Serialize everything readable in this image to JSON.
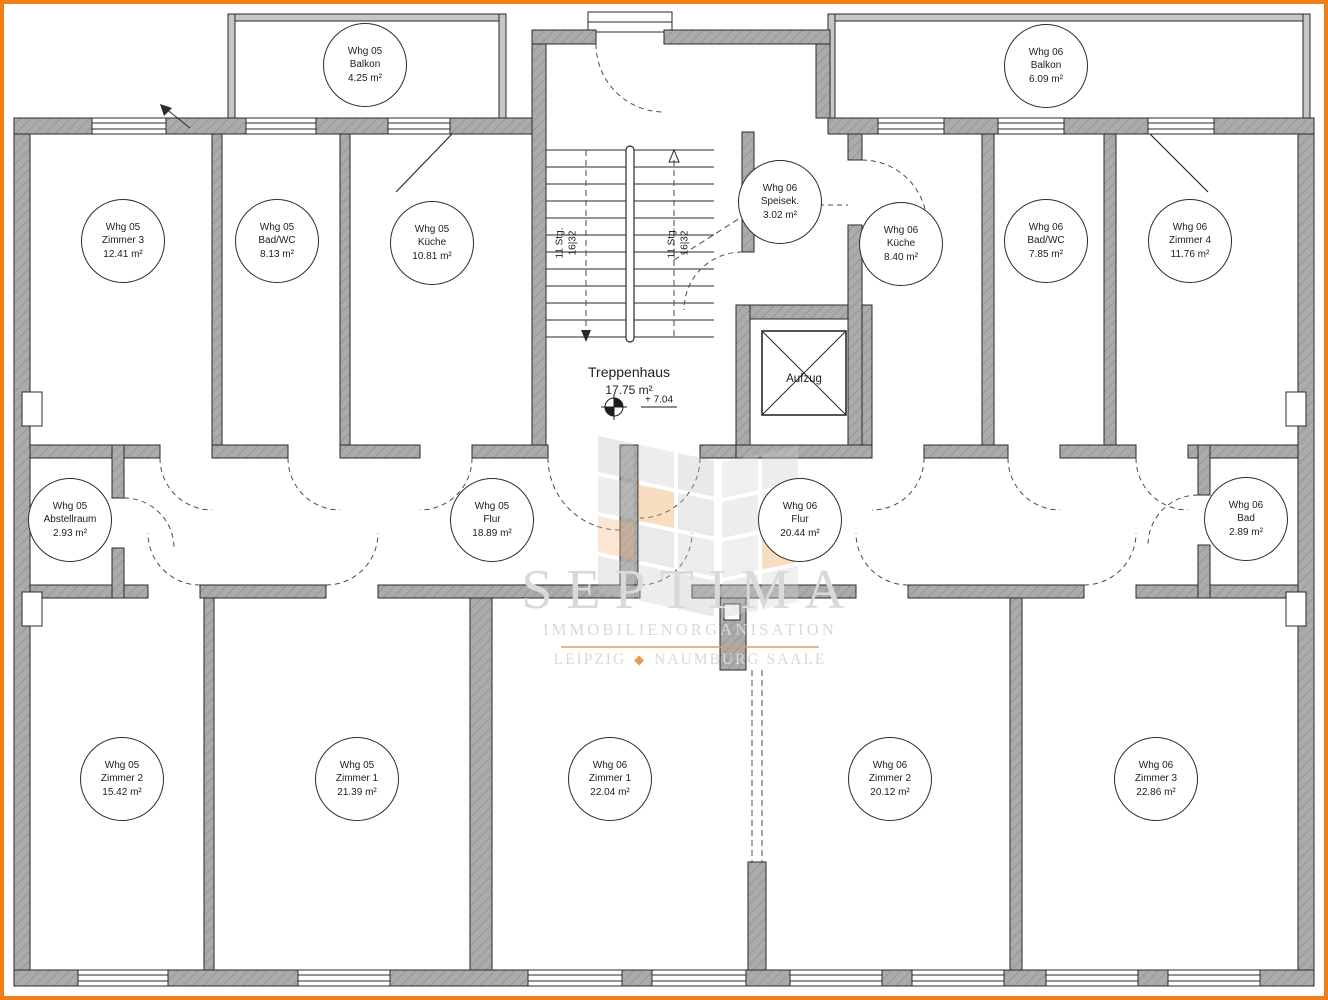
{
  "plan": {
    "border_color": "#f07f18",
    "wall_color": "#ababab",
    "line_color": "#2a2a2a"
  },
  "stairwell": {
    "name": "Treppenhaus",
    "area": "17.75 m²",
    "level": "+ 7.04",
    "flight_label": "11 Stg.",
    "flight_ratio": "16|32",
    "elevator": "Aufzug"
  },
  "watermark": {
    "brand": "SEPTIMA",
    "sub": "IMMOBILIENORGANISATION",
    "city1": "LEIPZIG",
    "sep": "◆",
    "city2": "NAUMBURG SAALE"
  },
  "rooms": [
    {
      "unit": "Whg 05",
      "name": "Balkon",
      "area": "4.25 m²",
      "cx": 365,
      "cy": 65
    },
    {
      "unit": "Whg 06",
      "name": "Balkon",
      "area": "6.09 m²",
      "cx": 1046,
      "cy": 66
    },
    {
      "unit": "Whg 05",
      "name": "Zimmer 3",
      "area": "12.41 m²",
      "cx": 123,
      "cy": 241
    },
    {
      "unit": "Whg 05",
      "name": "Bad/WC",
      "area": "8.13 m²",
      "cx": 277,
      "cy": 241
    },
    {
      "unit": "Whg 05",
      "name": "Küche",
      "area": "10.81 m²",
      "cx": 432,
      "cy": 243
    },
    {
      "unit": "Whg 06",
      "name": "Speisek.",
      "area": "3.02 m²",
      "cx": 780,
      "cy": 202
    },
    {
      "unit": "Whg 06",
      "name": "Küche",
      "area": "8.40 m²",
      "cx": 901,
      "cy": 244
    },
    {
      "unit": "Whg 06",
      "name": "Bad/WC",
      "area": "7.85 m²",
      "cx": 1046,
      "cy": 241
    },
    {
      "unit": "Whg 06",
      "name": "Zimmer 4",
      "area": "11.76 m²",
      "cx": 1190,
      "cy": 241
    },
    {
      "unit": "Whg 05",
      "name": "Abstellraum",
      "area": "2.93 m²",
      "cx": 70,
      "cy": 520
    },
    {
      "unit": "Whg 05",
      "name": "Flur",
      "area": "18.89 m²",
      "cx": 492,
      "cy": 520
    },
    {
      "unit": "Whg 06",
      "name": "Flur",
      "area": "20.44 m²",
      "cx": 800,
      "cy": 520
    },
    {
      "unit": "Whg 06",
      "name": "Bad",
      "area": "2.89 m²",
      "cx": 1246,
      "cy": 519
    },
    {
      "unit": "Whg 05",
      "name": "Zimmer 2",
      "area": "15.42 m²",
      "cx": 122,
      "cy": 779
    },
    {
      "unit": "Whg 05",
      "name": "Zimmer 1",
      "area": "21.39 m²",
      "cx": 357,
      "cy": 779
    },
    {
      "unit": "Whg 06",
      "name": "Zimmer 1",
      "area": "22.04 m²",
      "cx": 610,
      "cy": 779
    },
    {
      "unit": "Whg 06",
      "name": "Zimmer 2",
      "area": "20.12 m²",
      "cx": 890,
      "cy": 779
    },
    {
      "unit": "Whg 06",
      "name": "Zimmer 3",
      "area": "22.86 m²",
      "cx": 1156,
      "cy": 779
    }
  ]
}
